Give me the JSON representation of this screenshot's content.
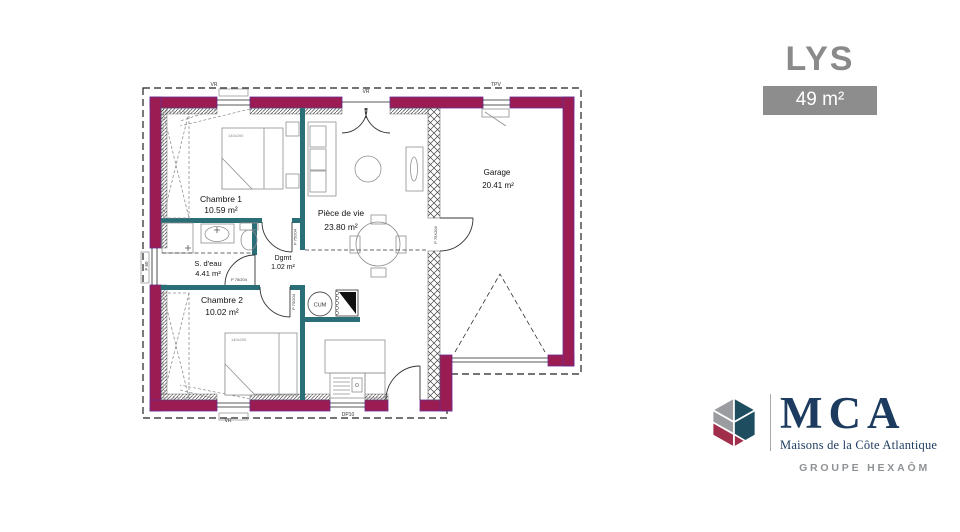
{
  "header": {
    "model_name": "LYS",
    "area_label": "49 m²"
  },
  "floor_plan": {
    "rooms": [
      {
        "name": "Chambre 1",
        "area": "10.59 m²"
      },
      {
        "name": "S. d'eau",
        "area": "4.41 m²"
      },
      {
        "name": "Chambre 2",
        "area": "10.02 m²"
      },
      {
        "name": "Dgmt",
        "area": "1.02 m²"
      },
      {
        "name": "Pièce de vie",
        "area": "23.80 m²"
      },
      {
        "name": "Garage",
        "area": "20.41 m²"
      }
    ],
    "annotations": {
      "bed_size": "140x200",
      "water_heater": "CUM",
      "door_label": "P 75/204",
      "garage_door_label": "P 75X204",
      "roller_shutter": "VR",
      "garage_window": "TPV",
      "side_window": "F 60",
      "downspout": "DP10"
    },
    "colors": {
      "exterior_wall": "#9B1B53",
      "interior_wall": "#2A6E78",
      "outline": "#6A2D91"
    }
  },
  "branding": {
    "acronym": "MCA",
    "name": "Maisons de la Côte Atlantique",
    "group": "GROUPE HEXAÔM"
  }
}
